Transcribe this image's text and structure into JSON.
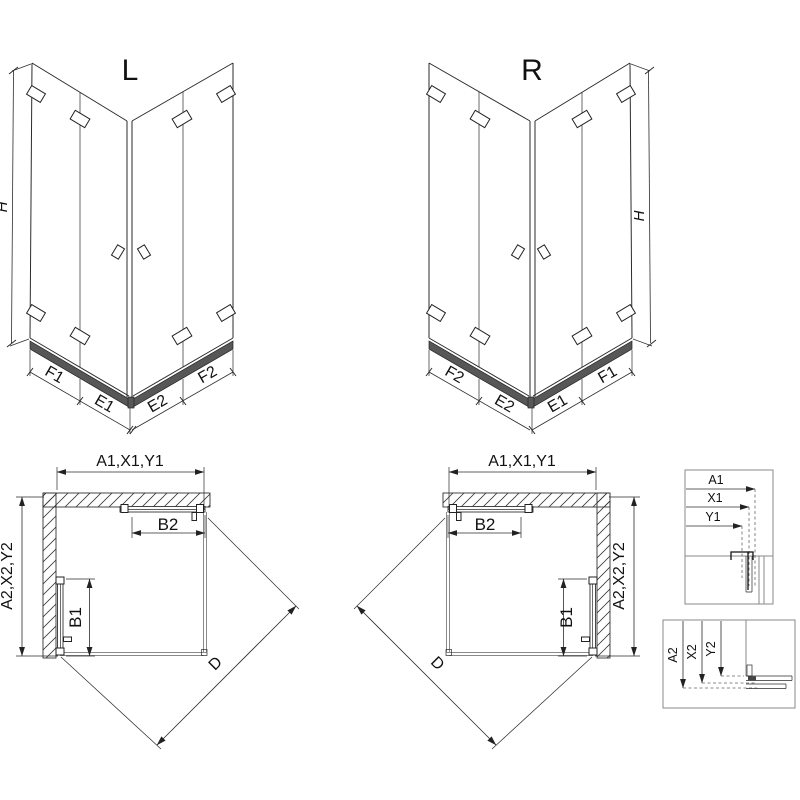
{
  "colors": {
    "line": "#2b2b2b",
    "gray_line": "#8a8a8a",
    "tray_fill": "#575757",
    "background": "#ffffff"
  },
  "perspective_left": {
    "variant": "L",
    "height_dim": "H",
    "segments": {
      "f1": "F1",
      "e1": "E1",
      "e2": "E2",
      "f2": "F2"
    }
  },
  "perspective_right": {
    "variant": "R",
    "height_dim": "H",
    "segments": {
      "f2": "F2",
      "e2": "E2",
      "e1": "E1",
      "f1": "F1"
    }
  },
  "plan_left": {
    "width_dim": "A1,X1,Y1",
    "depth_dim": "A2,X2,Y2",
    "door_fold_width": "B2",
    "door_fold_depth": "B1",
    "entry_diagonal": "D"
  },
  "plan_right": {
    "width_dim": "A1,X1,Y1",
    "depth_dim": "A2,X2,Y2",
    "door_fold_width": "B2",
    "door_fold_depth": "B1",
    "entry_diagonal": "D"
  },
  "detail_top": {
    "dims": [
      "A1",
      "X1",
      "Y1"
    ]
  },
  "detail_bottom": {
    "dims": [
      "A2",
      "X2",
      "Y2"
    ]
  }
}
